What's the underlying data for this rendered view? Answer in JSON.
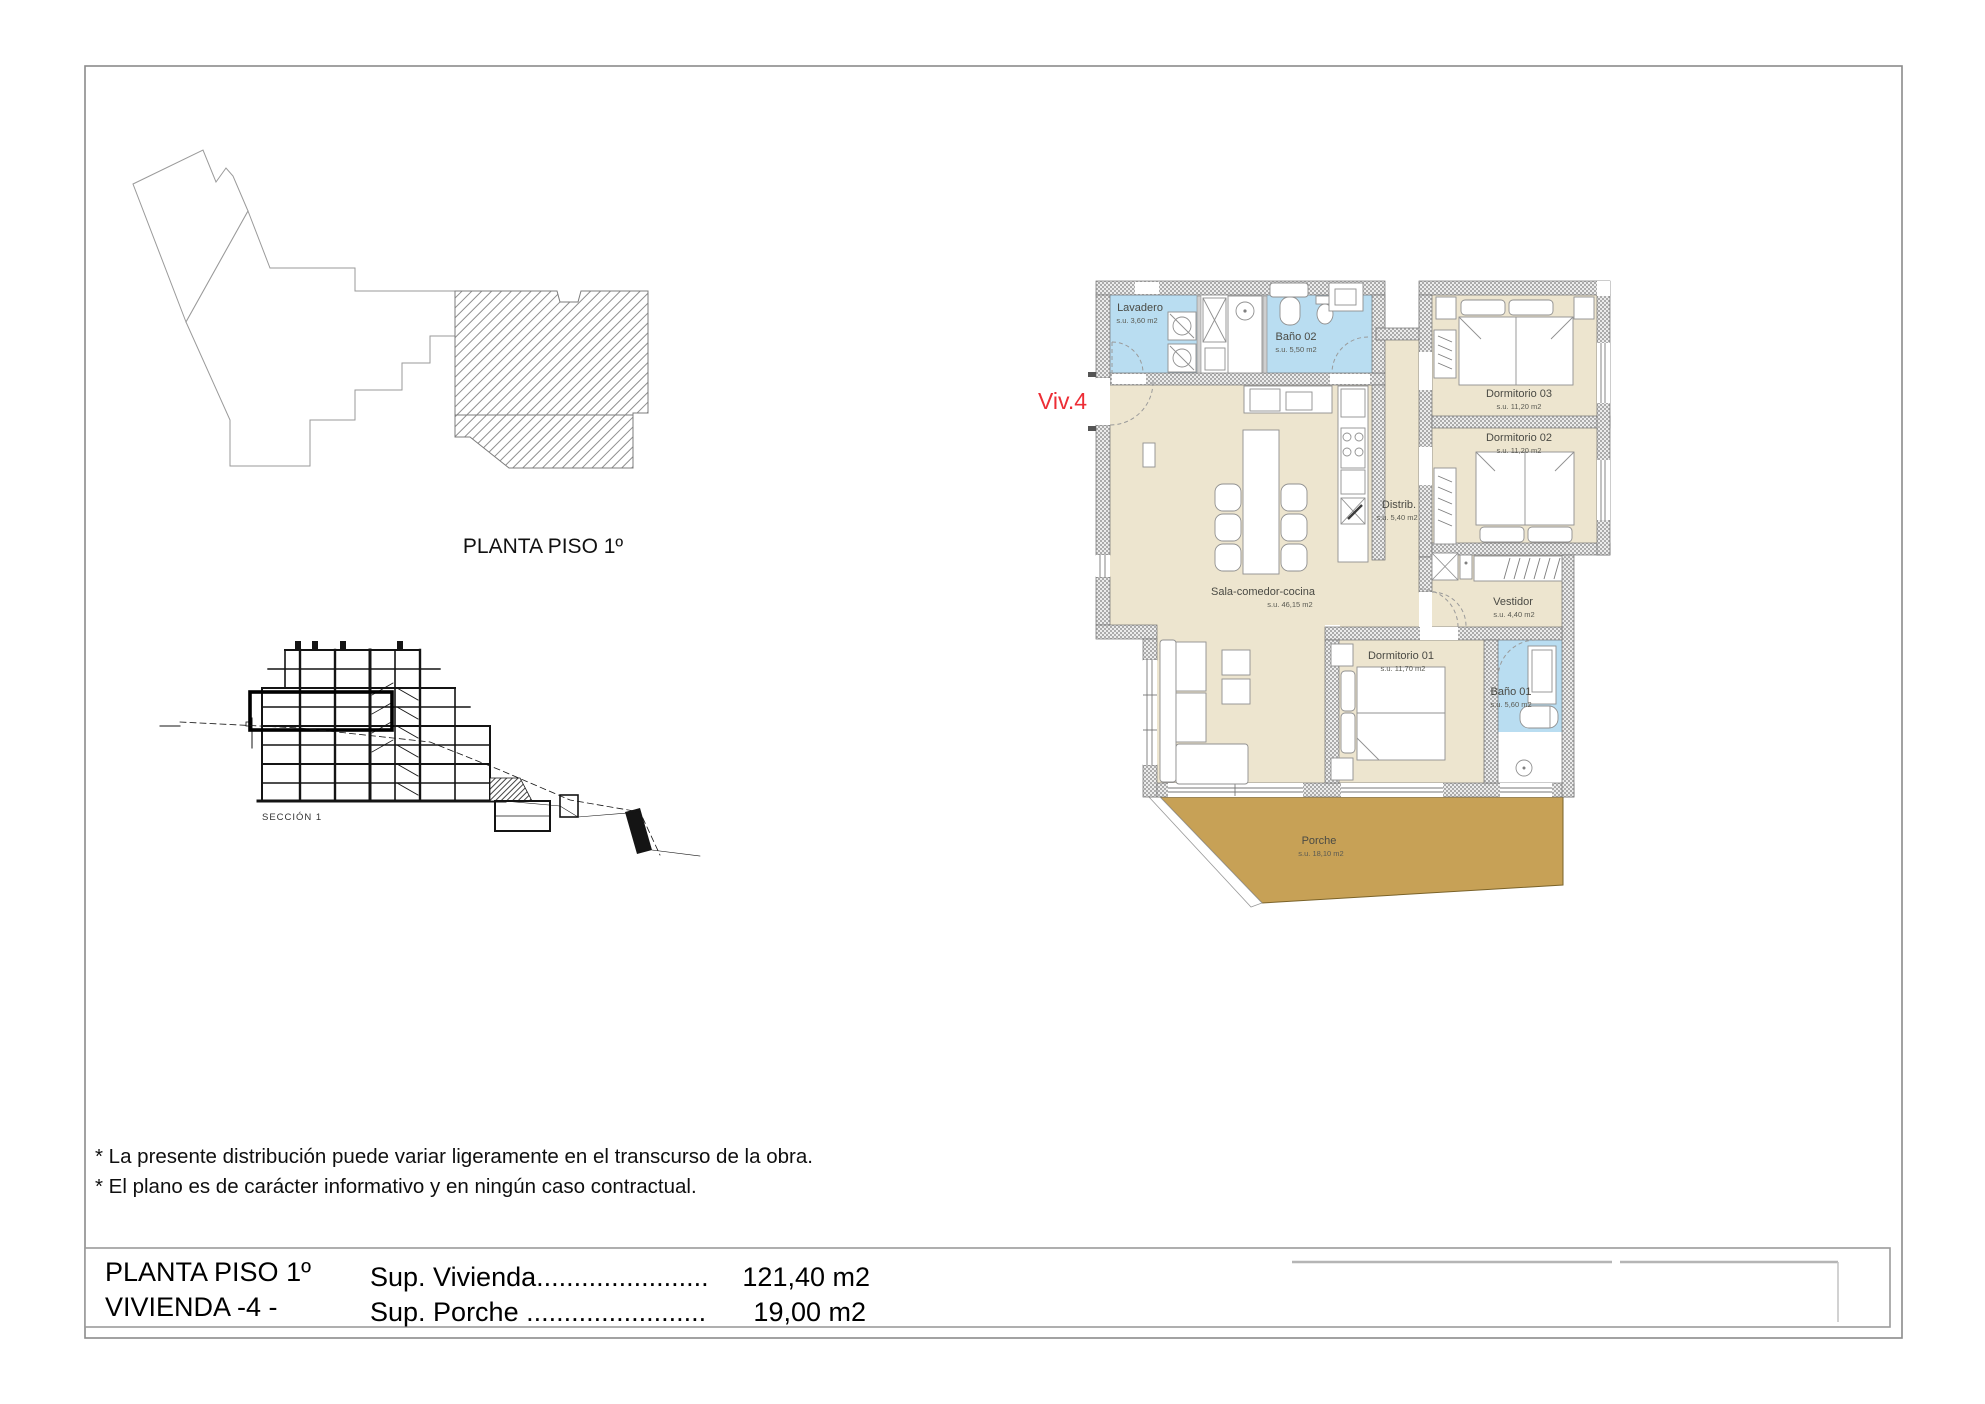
{
  "site_plan": {
    "label": "PLANTA PISO 1º"
  },
  "section": {
    "label": "SECCIÓN 1"
  },
  "unit_label": {
    "text": "Viv.4",
    "color": "#ed2d35"
  },
  "floor_plan": {
    "rooms": [
      {
        "name": "Lavadero",
        "area": "s.u. 3,60 m2"
      },
      {
        "name": "Baño 02",
        "area": "s.u. 5,50 m2"
      },
      {
        "name": "Dormitorio 03",
        "area": "s.u. 11,20 m2"
      },
      {
        "name": "Dormitorio 02",
        "area": "s.u. 11,20 m2"
      },
      {
        "name": "Distrib.",
        "area": "s.u. 5,40 m2"
      },
      {
        "name": "Sala-comedor-cocina",
        "area": "s.u. 46,15 m2"
      },
      {
        "name": "Vestidor",
        "area": "s.u. 4,40 m2"
      },
      {
        "name": "Dormitorio 01",
        "area": "s.u. 11,70 m2"
      },
      {
        "name": "Baño 01",
        "area": "s.u. 5,60 m2"
      },
      {
        "name": "Porche",
        "area": "s.u. 18,10 m2"
      }
    ],
    "colors": {
      "room_fill": "#EDE5CF",
      "wet_fill": "#B9DDF1",
      "porch_fill": "#C7A156",
      "wall_dark": "#6f6f6f"
    }
  },
  "notes": {
    "line1": "* La presente distribución puede variar ligeramente en el transcurso de la obra.",
    "line2": "* El plano es de carácter informativo y en ningún caso contractual."
  },
  "title_block": {
    "line1": "PLANTA PISO 1º",
    "line2": "VIVIENDA -4 -",
    "sup_vivienda_label": "Sup. Vivienda.......................",
    "sup_vivienda_value": "121,40 m2",
    "sup_porche_label": "Sup. Porche ........................",
    "sup_porche_value": "19,00 m2"
  }
}
